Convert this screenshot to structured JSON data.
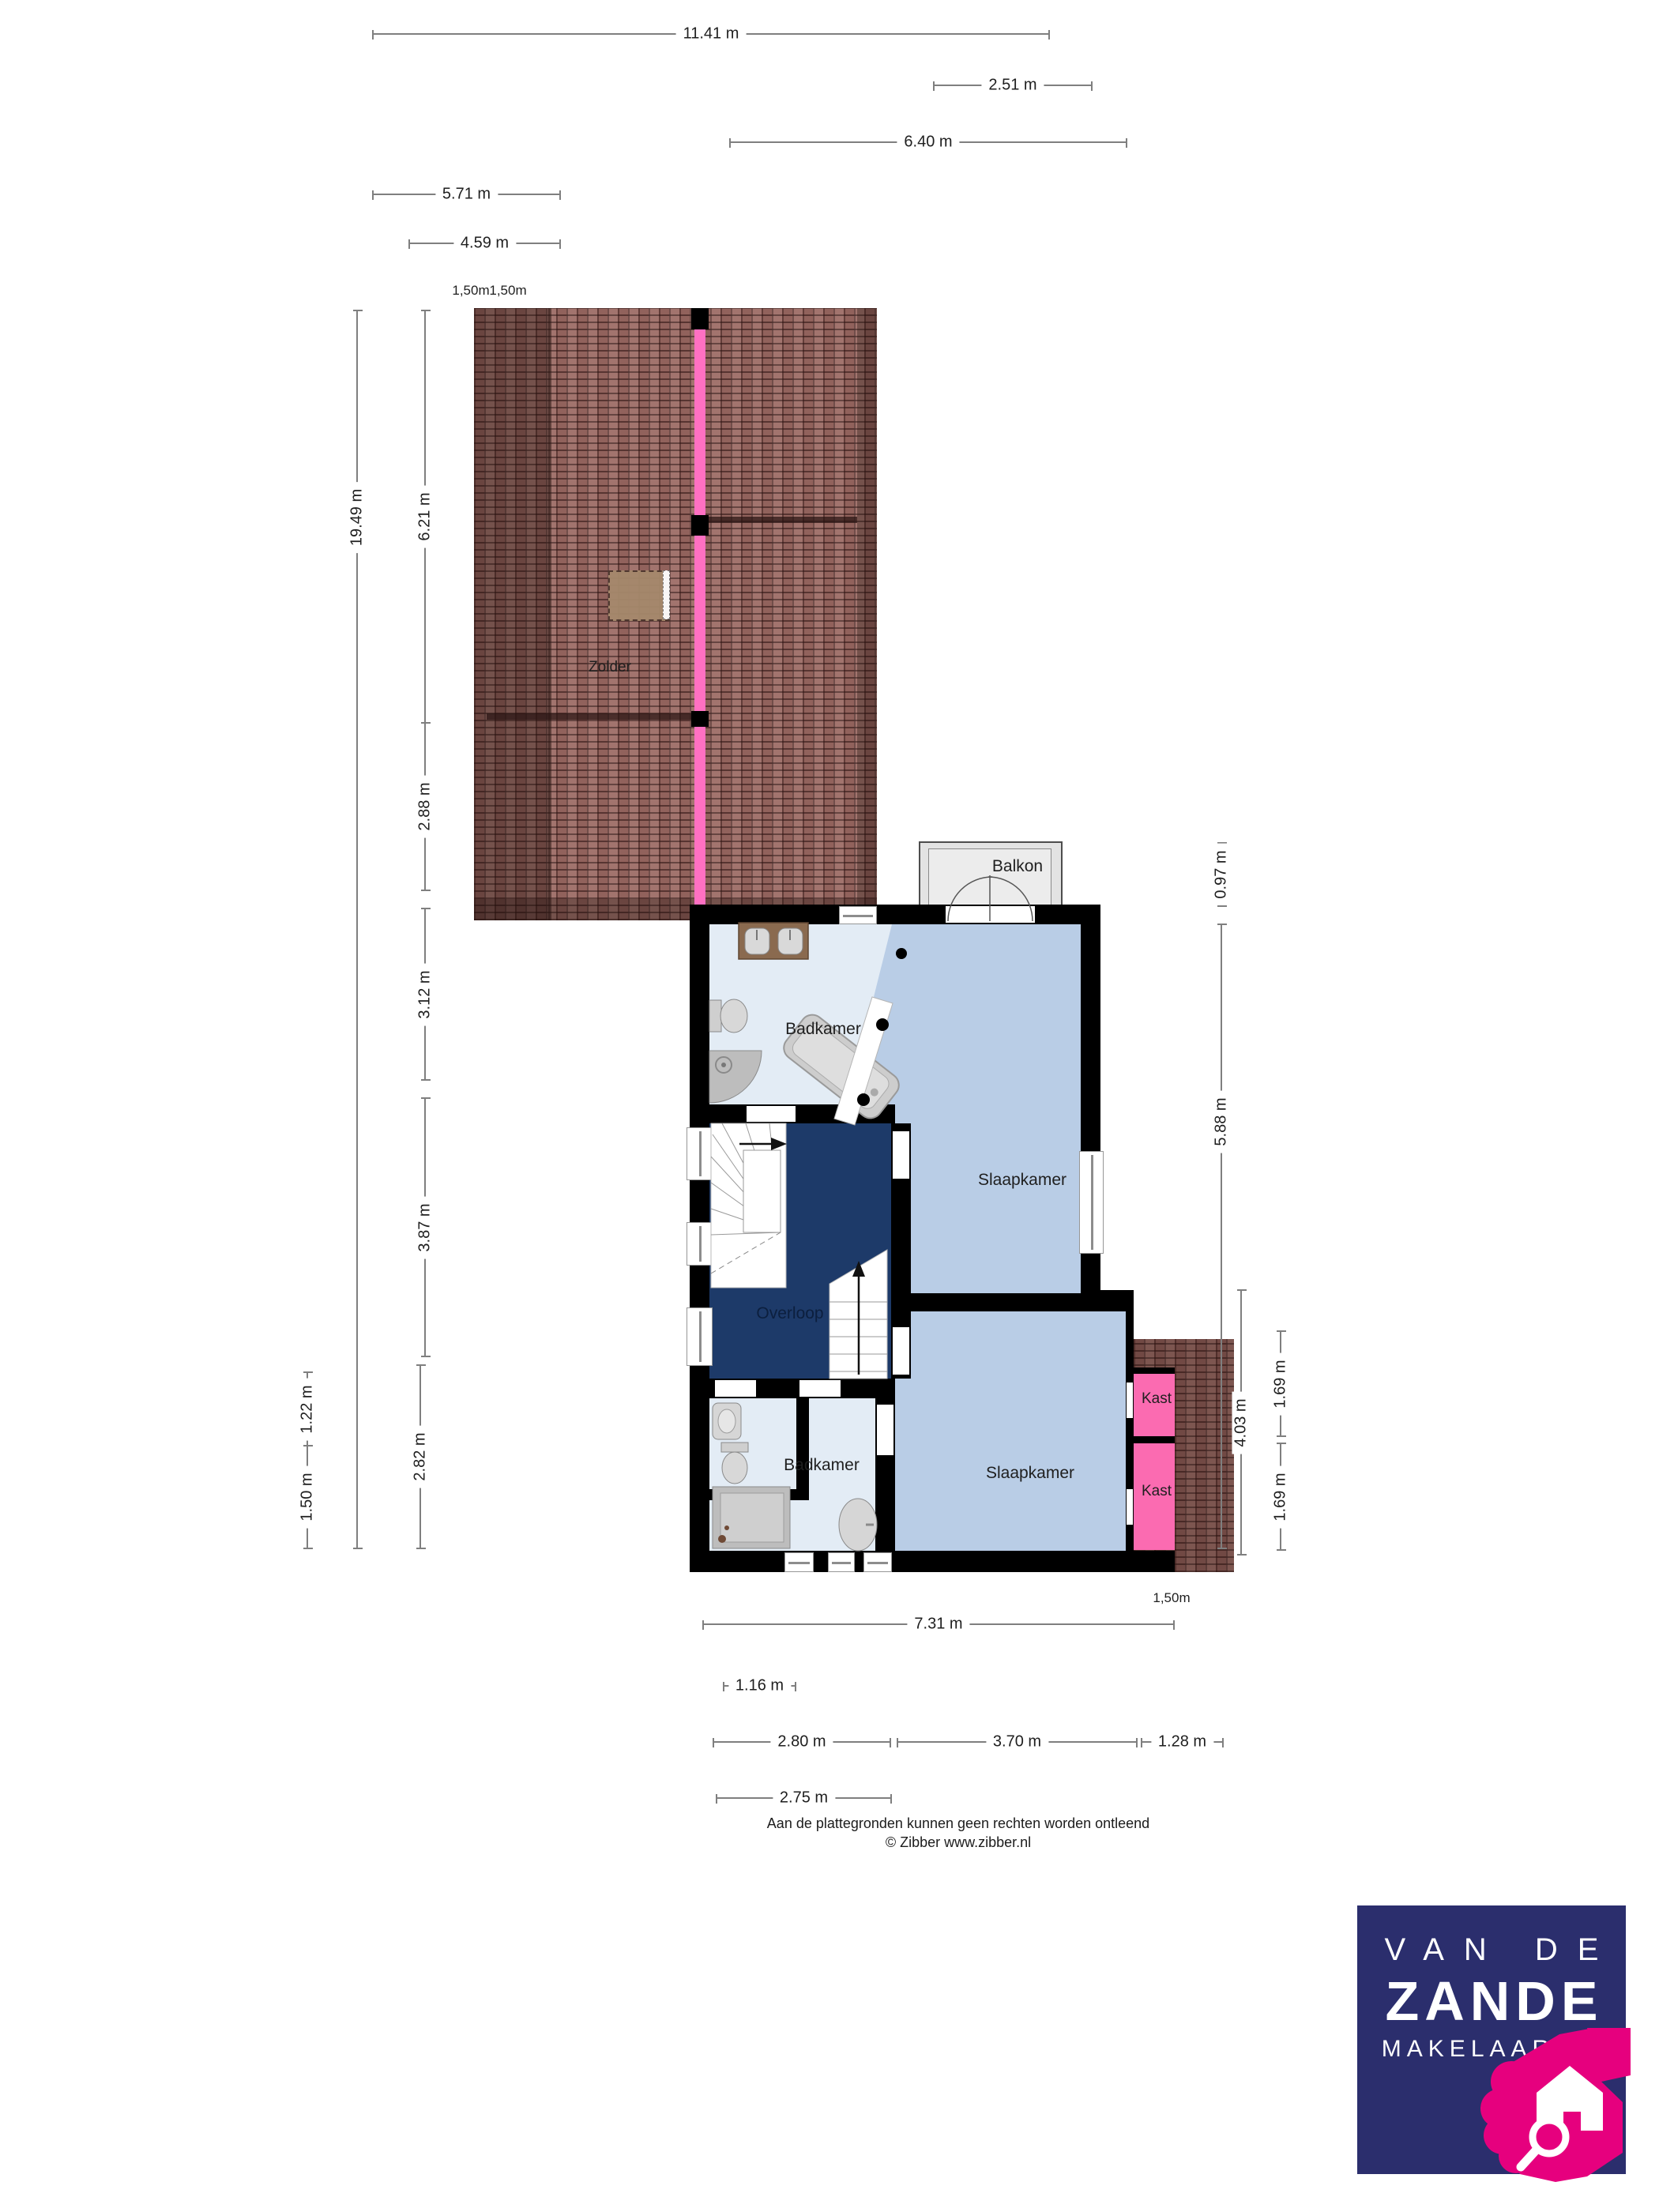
{
  "rooms": {
    "zolder": "Zolder",
    "balkon": "Balkon",
    "badkamer_boven": "Badkamer",
    "slaapkamer_voor": "Slaapkamer",
    "overloop": "Overloop",
    "badkamer_beneden": "Badkamer",
    "slaapkamer_achter": "Slaapkamer",
    "kast_1": "Kast",
    "kast_2": "Kast"
  },
  "dims": {
    "top": [
      "11.41 m",
      "2.51 m",
      "6.40 m",
      "5.71 m",
      "4.59 m"
    ],
    "ridge_labels": [
      "1,50m",
      "1,50m"
    ],
    "left": [
      "19.49 m",
      "6.21 m",
      "2.88 m",
      "3.12 m",
      "3.87 m",
      "2.82 m",
      "1.22 m",
      "1.50 m"
    ],
    "right": [
      "0.97 m",
      "5.88 m",
      "4.03 m",
      "1.69 m",
      "1.69 m"
    ],
    "bottom": [
      "7.31 m",
      "1.16 m",
      "2.80 m",
      "3.70 m",
      "1.28 m",
      "2.75 m"
    ],
    "corner_label": "1,50m"
  },
  "footer": {
    "disclaimer": "Aan de plattegronden kunnen geen rechten worden ontleend",
    "copyright": "© Zibber www.zibber.nl"
  },
  "logo": {
    "line1": "VAN DE",
    "line2": "ZANDE",
    "line3": "MAKELAARDIJ"
  },
  "colors": {
    "wall": "#000000",
    "bedroom_floor": "#b9cde6",
    "bathroom_floor": "#e3ecf5",
    "landing_floor": "#1d3a69",
    "closet_pink": "#fb6bb1",
    "ridge_pink": "#ff70c2",
    "roof_tile": "#9b6a63",
    "roof_dark": "#5f3d38",
    "balcony_gray": "#e3e3e3",
    "dim_line": "#7f7f7f",
    "text": "#1f1f1f",
    "logo_navy": "#2b2e6d",
    "logo_pink": "#e6007e"
  }
}
